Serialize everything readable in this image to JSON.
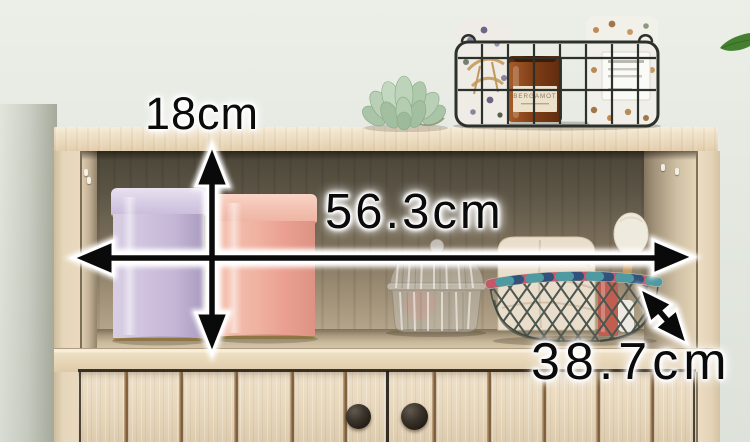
{
  "dimensions": {
    "inner_height": {
      "label": "18cm",
      "orientation": "vertical"
    },
    "inner_width": {
      "label": "56.3cm",
      "orientation": "horizontal"
    },
    "depth": {
      "label": "38.7cm",
      "orientation": "diagonal"
    }
  },
  "decor": {
    "candle_label": "BERGAMOT"
  },
  "colors": {
    "wall": "#e5e9e1",
    "wood_light": "#ebdbc1",
    "interior_dark": "#55503f",
    "tin_lavender": "#c9bcd8",
    "tin_pink": "#f1b2a4",
    "annotation_text": "#0b0b0b",
    "annotation_halo": "#ffffff"
  },
  "layout_data": {
    "door_grooves_x": [
      124,
      179,
      234,
      290,
      343,
      432,
      487,
      542,
      596,
      650
    ]
  }
}
